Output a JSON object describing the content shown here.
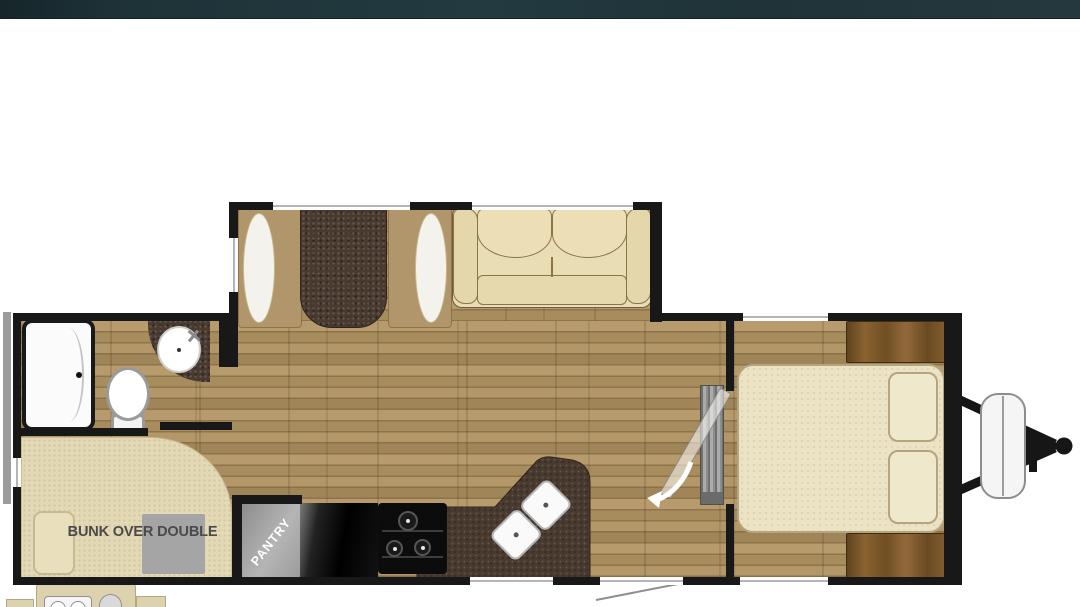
{
  "header": {
    "bar_color": "#1e3338"
  },
  "floorplan": {
    "labels": {
      "bunk_bed": "BUNK OVER DOUBLE",
      "pantry": "PANTRY"
    },
    "colors": {
      "wall": "#181818",
      "floor_base": "#a98e60",
      "counter_dark": "#483a2f",
      "bunk_beige": "#e4d9b5",
      "bed_cream": "#ece3c5",
      "sofa_cream": "#e9ddb4",
      "fixture_gray": "#9d9d9d",
      "cabinet_brown": "#7a5a2e",
      "window_line": "#b5b5b5"
    }
  }
}
